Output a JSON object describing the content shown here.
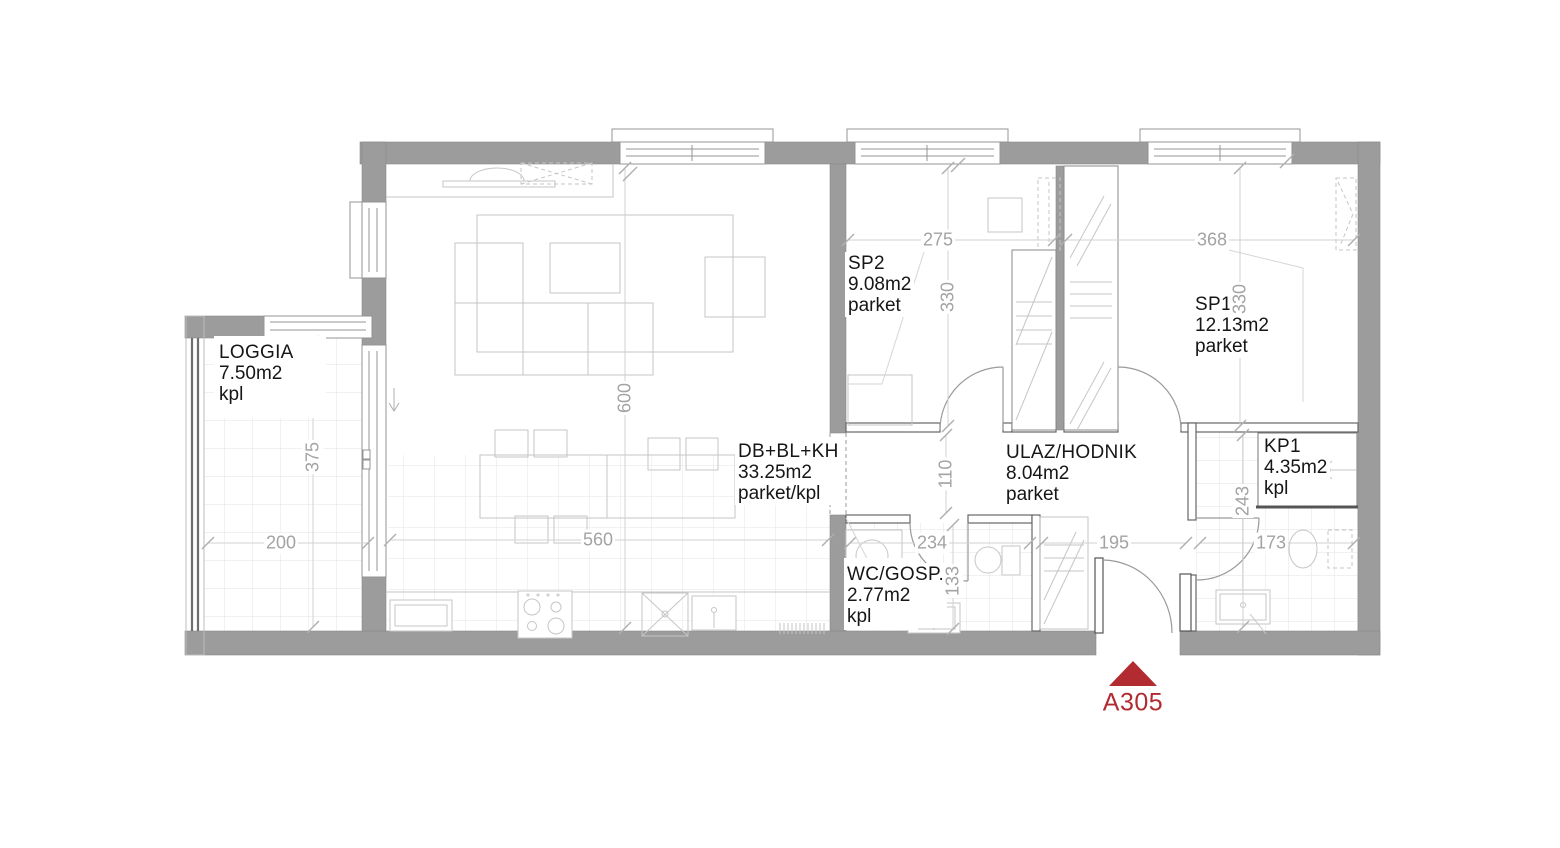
{
  "plan": {
    "unit": {
      "label": "A305"
    },
    "colors": {
      "wall": "#9c9c9c",
      "accent": "#b12b31",
      "dim-text": "#a3a3a3",
      "room-text": "#161616",
      "furniture-line": "#c6c6c6"
    },
    "rooms": [
      {
        "id": "loggia",
        "name": "LOGGIA",
        "area": "7.50m2",
        "floor": "kpl"
      },
      {
        "id": "living",
        "name": "DB+BL+KH",
        "area": "33.25m2",
        "floor": "parket/kpl"
      },
      {
        "id": "sp2",
        "name": "SP2",
        "area": "9.08m2",
        "floor": "parket"
      },
      {
        "id": "sp1",
        "name": "SP1",
        "area": "12.13m2",
        "floor": "parket"
      },
      {
        "id": "hodnik",
        "name": "ULAZ/HODNIK",
        "area": "8.04m2",
        "floor": "parket"
      },
      {
        "id": "kp1",
        "name": "KP1",
        "area": "4.35m2",
        "floor": "kpl"
      },
      {
        "id": "wc",
        "name": "WC/GOSP.",
        "area": "2.77m2",
        "floor": "kpl"
      }
    ],
    "dimensions": [
      {
        "id": "sp2-width",
        "value": "275"
      },
      {
        "id": "sp2-depth",
        "value": "330"
      },
      {
        "id": "sp1-width",
        "value": "368"
      },
      {
        "id": "sp1-depth",
        "value": "330"
      },
      {
        "id": "living-depth",
        "value": "600"
      },
      {
        "id": "loggia-depth",
        "value": "375"
      },
      {
        "id": "loggia-width",
        "value": "200"
      },
      {
        "id": "living-width",
        "value": "560"
      },
      {
        "id": "passage-width",
        "value": "110"
      },
      {
        "id": "wc-width",
        "value": "234"
      },
      {
        "id": "wc-depth",
        "value": "133"
      },
      {
        "id": "hall-width",
        "value": "195"
      },
      {
        "id": "kp1-depth",
        "value": "243"
      },
      {
        "id": "kp1-width",
        "value": "173"
      }
    ]
  }
}
